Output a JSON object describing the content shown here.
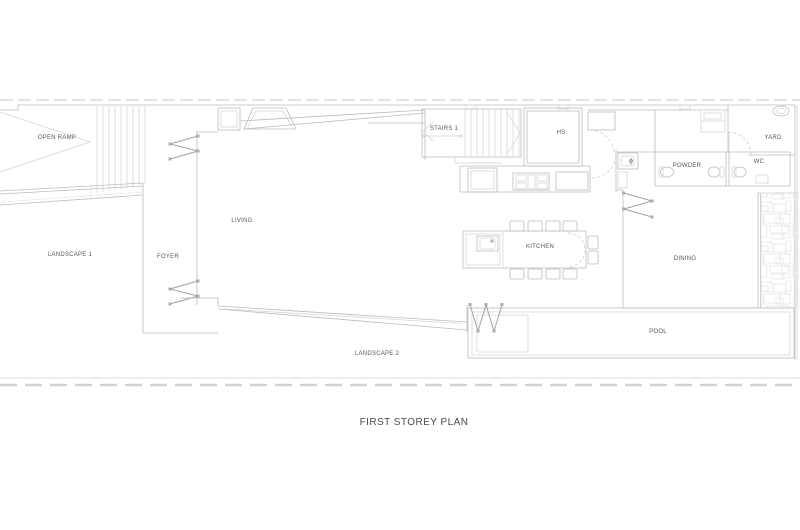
{
  "title": "FIRST STOREY PLAN",
  "labels": {
    "open_ramp": "OPEN RAMP",
    "landscape1": "LANDSCAPE 1",
    "foyer": "FOYER",
    "living": "LIVING",
    "stairs1": "STAIRS 1",
    "hs": "HS",
    "kitchen": "KITCHEN",
    "powder": "POWDER",
    "wc": "WC",
    "yard": "YARD",
    "dining": "DINING",
    "pool": "POOL",
    "landscape2": "LANDSCAPE 2"
  },
  "colors": {
    "background": "#ffffff",
    "wall_line": "#bcbcbc",
    "door_symbol": "#a2a2a2",
    "label_text": "#575757",
    "title_text": "#4a4a4a"
  }
}
